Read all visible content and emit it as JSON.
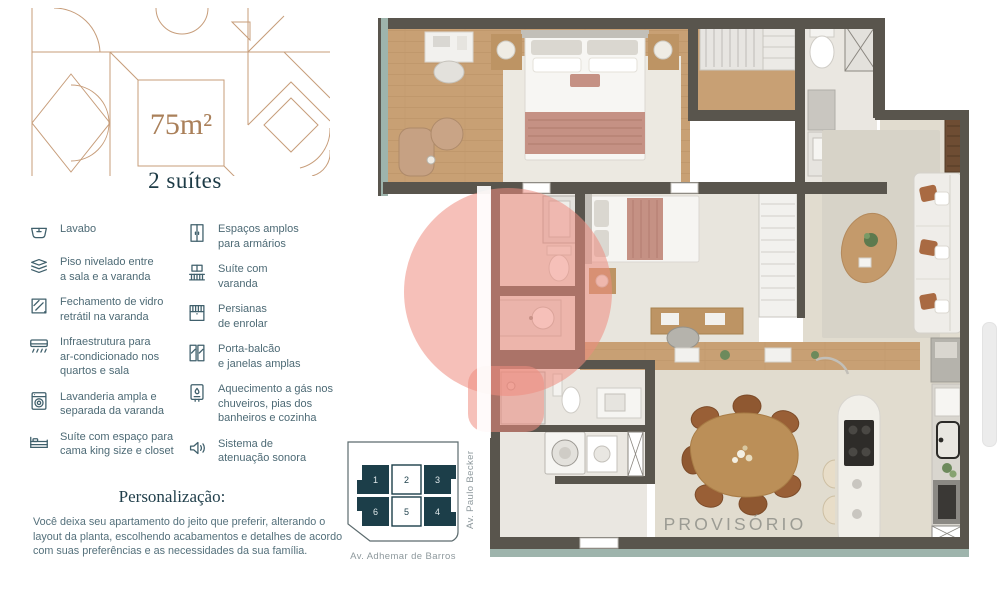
{
  "unit": {
    "area_label": "75m²",
    "suites_label": "2 suítes"
  },
  "features": {
    "column1": [
      {
        "icon": "sink-icon",
        "text": "Lavabo"
      },
      {
        "icon": "floor-levels-icon",
        "text": "Piso nivelado entre\na sala e a varanda"
      },
      {
        "icon": "glass-panel-icon",
        "text": "Fechamento de vidro\nretrátil na varanda"
      },
      {
        "icon": "air-conditioner-icon",
        "text": "Infraestrutura para\nar-condicionado nos\nquartos e sala"
      },
      {
        "icon": "washing-machine-icon",
        "text": "Lavanderia ampla e\nseparada da varanda"
      },
      {
        "icon": "bed-icon",
        "text": "Suíte com espaço para\ncama king size e closet"
      }
    ],
    "column2": [
      {
        "icon": "wardrobe-icon",
        "text": "Espaços amplos\npara armários"
      },
      {
        "icon": "balcony-icon",
        "text": "Suíte com\nvaranda"
      },
      {
        "icon": "roller-blind-icon",
        "text": "Persianas\nde enrolar"
      },
      {
        "icon": "balcony-door-icon",
        "text": "Porta-balcão\ne janelas amplas"
      },
      {
        "icon": "gas-heater-icon",
        "text": "Aquecimento a gás nos\nchuveiros, pias dos\nbanheiros e cozinha"
      },
      {
        "icon": "sound-attenuation-icon",
        "text": "Sistema de\natenuação sonora"
      }
    ]
  },
  "personalization": {
    "heading": "Personalização:",
    "body": "Você deixa seu apartamento do jeito que preferir, alterando o\nlayout da planta, escolhendo acabamentos e detalhes de acordo\ncom suas preferências e as necessidades da sua família."
  },
  "keyplan": {
    "units": [
      {
        "number": "1",
        "highlighted": false
      },
      {
        "number": "2",
        "highlighted": true
      },
      {
        "number": "3",
        "highlighted": false
      },
      {
        "number": "6",
        "highlighted": false
      },
      {
        "number": "5",
        "highlighted": true
      },
      {
        "number": "4",
        "highlighted": false
      }
    ],
    "streets": {
      "right": "Av. Paulo Becker",
      "bottom": "Av. Adhemar de Barros"
    }
  },
  "floorplan": {
    "watermark_text": "PROVISÓRIO"
  },
  "colors": {
    "accent_brown": "#aa805a",
    "deco_line": "#c79d7a",
    "navy": "#1d3b46",
    "feature_text": "#4d6a75",
    "keyplan_dark": "#1c3e49",
    "street_gray": "#8d989c",
    "wall": "#59554d",
    "wood": "#c8a074",
    "light_floor": "#eae7e1",
    "living_floor": "#e1dccf",
    "rose": "#c59184",
    "watermark_salmon": "#ef8c80",
    "provisional_gray": "#9b9b93"
  }
}
